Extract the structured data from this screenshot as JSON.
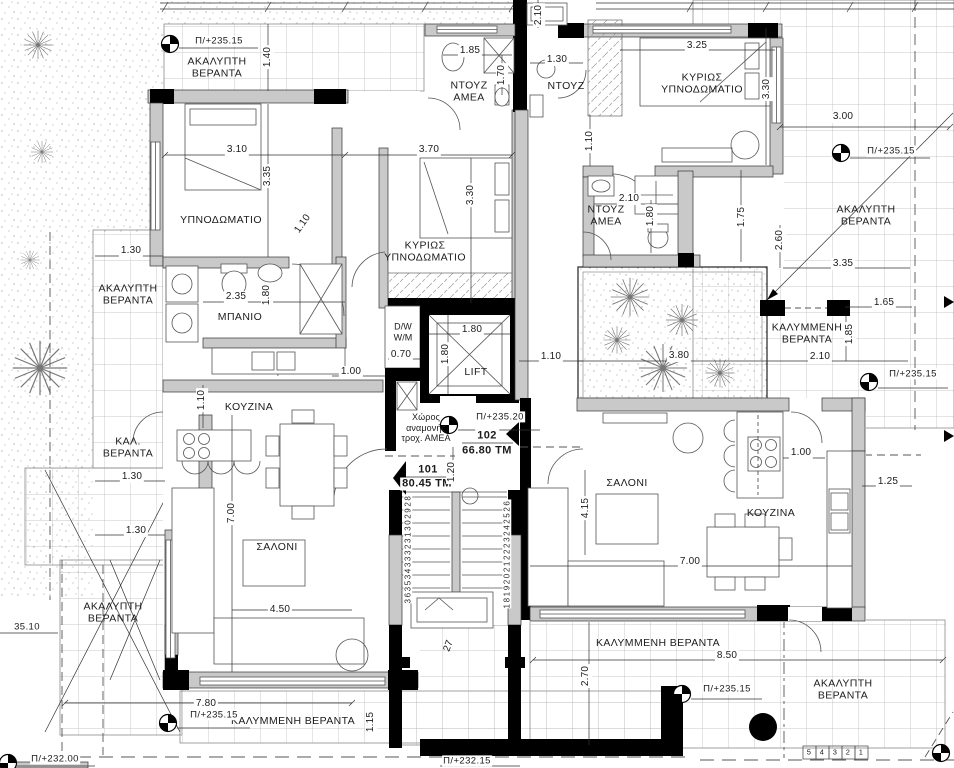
{
  "rooms": {
    "akalypti_veranta": "ΑΚΑΛΥΠΤΗ\nΒΕΡΑΝΤΑ",
    "kalymmeni_veranta": "ΚΑΛΥΜΜΕΝΗ\nΒΕΡΑΝΤΑ",
    "kalymmeni_veranta_inline": "ΚΑΛΥΜΜΕΝΗ ΒΕΡΑΝΤΑ",
    "kal_veranta": "ΚΑΛ.\nΒΕΡΑΝΤΑ",
    "ypnodomatio": "ΥΠΝΟΔΩΜΑΤΙΟ",
    "kyrios_ypnodomatio": "ΚΥΡΙΩΣ\nΥΠΝΟΔΩΜΑΤΙΟ",
    "ntouz": "ΝΤΟΥΖ",
    "ntouz_amea": "ΝΤΟΥΖ\nΑΜΕΑ",
    "mpanio": "ΜΠΑΝΙΟ",
    "kouzina": "ΚΟΥΖΙΝΑ",
    "saloni": "ΣΑΛΟΝΙ",
    "lift": "LIFT",
    "dw_wm": "D/W\nW/M",
    "amea_waiting": "Χώρος\nαναμονής\nτροχ. ΑΜΕΑ"
  },
  "apartments": {
    "a101": {
      "number": "101",
      "area": "80.45 ΤΜ"
    },
    "a102": {
      "number": "102",
      "area": "66.80 ΤΜ"
    }
  },
  "levels": {
    "p235_15": "Π/+235.15",
    "p235_20": "Π/+235.20",
    "p235_10": "35.10",
    "p232_00": "Π/+232.00",
    "p232_15": "Π/+232.15"
  },
  "dims": {
    "d070": "0.70",
    "d100": "1.00",
    "d110": "1.10",
    "d115": "1.15",
    "d120": "1.20",
    "d125": "1.25",
    "d130": "1.30",
    "d140": "1.40",
    "d165": "1.65",
    "d170": "1.70",
    "d175": "1.75",
    "d180": "1.80",
    "d185": "1.85",
    "d210": "2.10",
    "d235": "2.35",
    "d260": "2.60",
    "d270": "2.70",
    "d300": "3.00",
    "d310": "3.10",
    "d325": "3.25",
    "d330": "3.30",
    "d335": "3.35",
    "d370": "3.70",
    "d380": "3.80",
    "d415": "4.15",
    "d450": "4.50",
    "d700": "7.00",
    "d780": "7.80",
    "d850": "8.50"
  },
  "stairs": {
    "flight_down": "363534333231302928",
    "flight_up": "181920212223242526",
    "step27": "27",
    "bottom_steps": [
      "5",
      "4",
      "3",
      "2",
      "1"
    ]
  }
}
